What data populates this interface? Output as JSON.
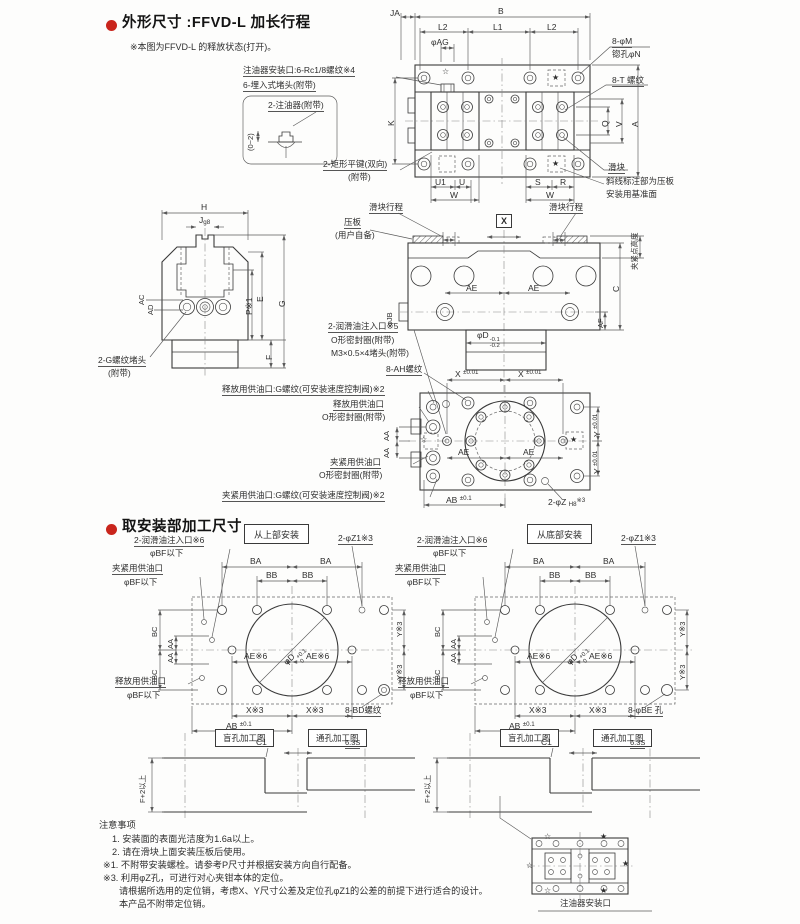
{
  "hdr": {
    "title1": "外形尺寸 :FFVD-L 加长行程",
    "note1": "※本图为FFVD-L 的释放状态(打开)。",
    "title2": "取安装部加工尺寸"
  },
  "sym": {
    "star": "★",
    "star_open": "☆"
  },
  "t": {
    "ja": "JA",
    "b": "B",
    "l2a": "L2",
    "l1": "L1",
    "l2b": "L2",
    "ag": "φAG",
    "k": "K",
    "u1": "U1",
    "u": "U",
    "w1": "W",
    "s": "S",
    "r": "R",
    "w2": "W",
    "q": "Q",
    "v": "V",
    "a": "A",
    "m8": "8-φM",
    "n": "锪孔φN",
    "t8": "8-T 螺纹",
    "slider": "滑块",
    "datum1": "斜线标注部为压板",
    "datum2": "安装用基准面",
    "oilport": "注油器安装口:6-Rc1/8螺纹※4",
    "plug6": "6-埋入式堵头(附带)",
    "oiler2": "2-注油器(附带)",
    "r02": "(0~2)",
    "key1": "2-矩形平键(双向)",
    "key2": "(附带)"
  },
  "f": {
    "h": "H",
    "j": "J",
    "jg8": "g8",
    "ac": "AC",
    "ad": "AD",
    "p": "P※1",
    "e": "E",
    "g": "G",
    "fd": "F",
    "plug1": "2-G螺纹堵头",
    "plug2": "(附带)"
  },
  "s": {
    "plate1": "压板",
    "plate2": "(用户自备)",
    "stroke1": "滑块行程",
    "stroke2": "滑块行程",
    "x": "X",
    "ae1": "AE",
    "ae2": "AE",
    "jb": "φJB",
    "c": "C",
    "af": "AF",
    "clampheight": "夹紧点高度",
    "d": "φD",
    "dtolu": "-0.1",
    "dtoll": "-0.2",
    "lube": "2-润滑油注入口※5",
    "oring": "O形密封圈(附带)",
    "m3": "M3×0.5×4堵头(附带)",
    "ah": "8-AH螺纹"
  },
  "bv": {
    "x1": "X",
    "x2": "X",
    "tolx": "±0.01",
    "y1": "Y",
    "y2": "Y",
    "ae1": "AE",
    "ae2": "AE",
    "ab": "AB",
    "tolab": "±0.1",
    "z": "2-φZ",
    "zsub": "H8",
    "zsup": "※3",
    "relg": "释放用供油口:G螺纹(可安装速度控制阀)※2",
    "rel": "释放用供油口",
    "oring1": "O形密封圈(附带)",
    "aa1": "AA",
    "aa2": "AA",
    "clamp": "夹紧用供油口",
    "oring2": "O形密封圈(附带)",
    "clampg": "夹紧用供油口:G螺纹(可安装速度控制阀)※2"
  },
  "m1": {
    "box": "从上部安装",
    "lube": "2-润滑油注入口※6",
    "bf1": "φBF以下",
    "clamp": "夹紧用供油口",
    "bf2": "φBF以下",
    "ba1": "BA",
    "ba2": "BA",
    "bb1": "BB",
    "bb2": "BB",
    "z1": "2-φZ1※3",
    "bc1": "BC",
    "bc2": "BC",
    "aa1": "AA",
    "aa2": "AA",
    "d": "φD",
    "dtu": "+0.1",
    "dtl": "0",
    "ae1": "AE※6",
    "ae2": "AE※6",
    "y1": "Y※3",
    "y2": "Y※3",
    "x1": "X※3",
    "x2": "X※3",
    "ab": "AB",
    "tol": "±0.1",
    "rel": "释放用供油口",
    "bf3": "φBF以下",
    "holes": "8-BD螺纹"
  },
  "m2": {
    "box": "从底部安装",
    "lube": "2-润滑油注入口※6",
    "bf1": "φBF以下",
    "clamp": "夹紧用供油口",
    "bf2": "φBF以下",
    "ba1": "BA",
    "ba2": "BA",
    "bb1": "BB",
    "bb2": "BB",
    "z1": "2-φZ1※3",
    "bc1": "BC",
    "bc2": "BC",
    "aa1": "AA",
    "aa2": "AA",
    "d": "φD",
    "dtu": "+0.1",
    "dtl": "0",
    "ae1": "AE※6",
    "ae2": "AE※6",
    "y1": "Y※3",
    "y2": "Y※3",
    "x1": "X※3",
    "x2": "X※3",
    "ab": "AB",
    "tol": "±0.1",
    "rel": "释放用供油口",
    "bf3": "φBF以下",
    "holes": "8-φBE 孔"
  },
  "sec": {
    "blind1": "盲孔加工图",
    "through1": "通孔加工图",
    "c1a": "C1",
    "fin1": "6.3S",
    "f2a": "F+2以上",
    "blind2": "盲孔加工图",
    "through2": "通孔加工图",
    "c1b": "C1",
    "fin2": "6.3S",
    "f2b": "F+2以上"
  },
  "notes": {
    "title": "注意事项",
    "i1": "1. 安装面的表面光洁度为1.6a以上。",
    "i2": "2. 请在滑块上面安装压板后使用。",
    "i3": "※1. 不附带安装螺栓。请参考P尺寸并根据安装方向自行配备。",
    "i4": "※3. 利用φZ孔，可进行对心夹钳本体的定位。",
    "i5": "请根据所选用的定位销，考虑X、Y尺寸公差及定位孔φZ1的公差的前提下进行适合的设计。",
    "i6": "本产品不附带定位销。"
  },
  "lub": {
    "caption": "注油器安装口"
  }
}
